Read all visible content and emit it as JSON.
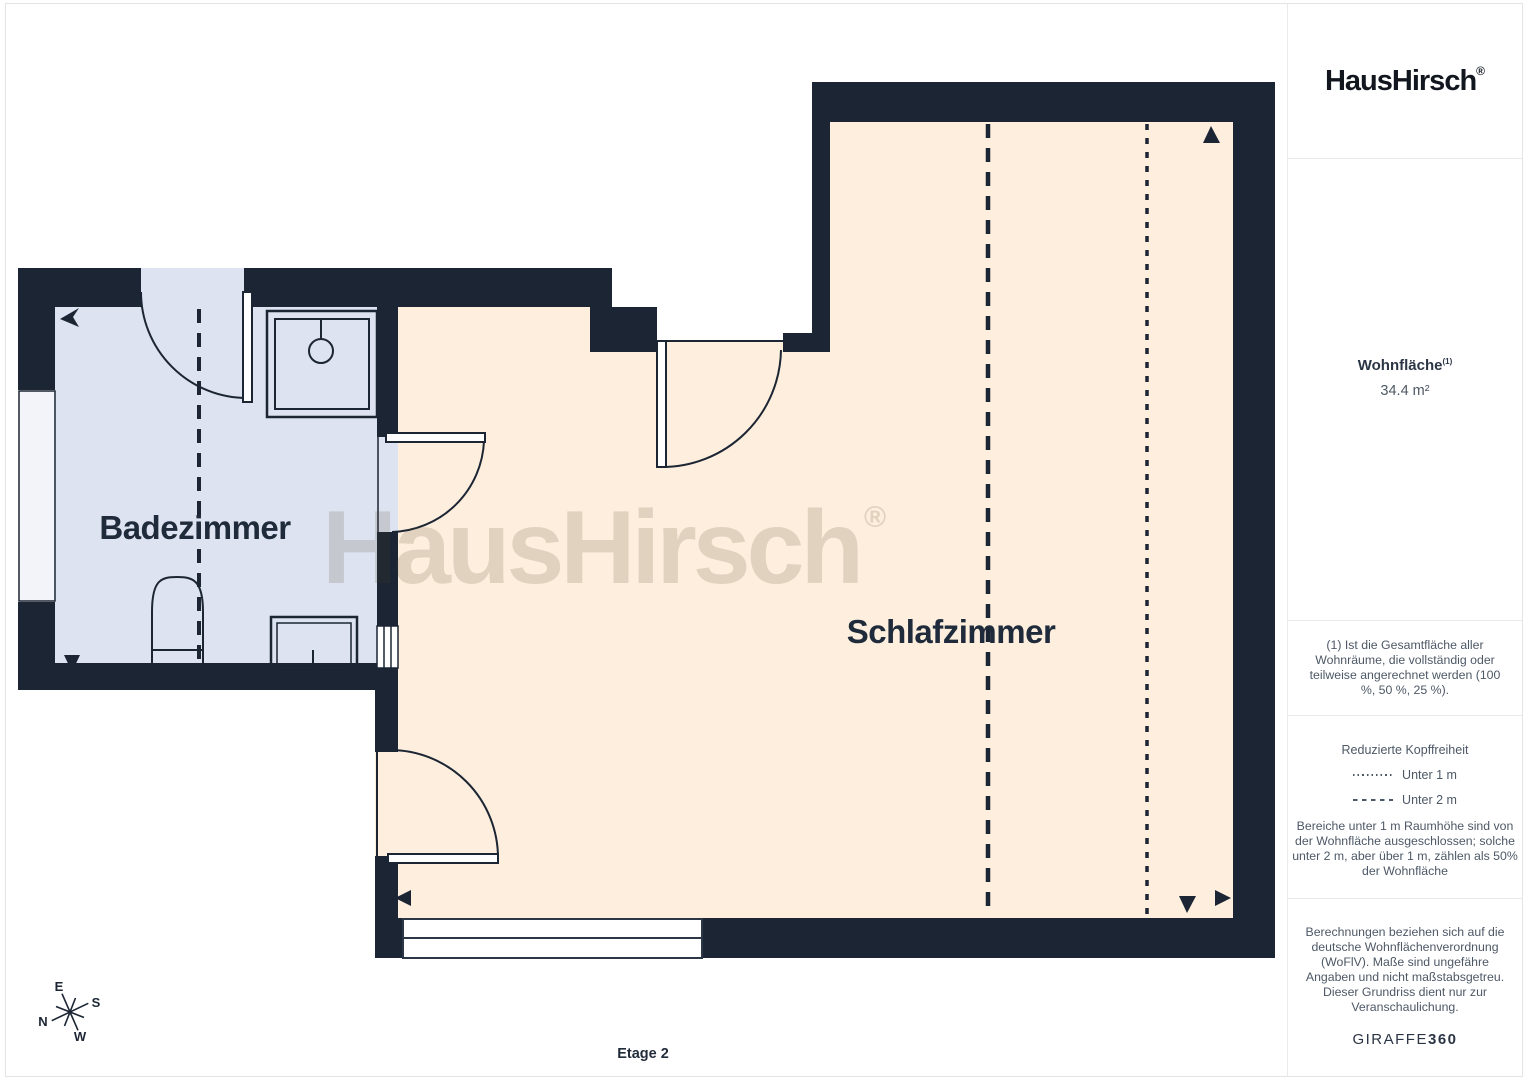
{
  "logo": {
    "brand": "HausHirsch",
    "registered": "®"
  },
  "floor_plan": {
    "rooms": [
      {
        "name": "Badezimmer"
      },
      {
        "name": "Schlafzimmer"
      }
    ],
    "watermark": {
      "text": "HausHirsch",
      "registered": "®"
    },
    "floor_label": "Etage 2",
    "compass": {
      "n": "N",
      "e": "E",
      "s": "S",
      "w": "W"
    },
    "colors": {
      "wall": "#1b2533",
      "bathroom_floor": "#dde3f0",
      "bedroom_floor": "#fdeedd",
      "window_fill": "#f3f4f9"
    }
  },
  "sidebar": {
    "area": {
      "label": "Wohnfläche",
      "footnote_ref": "(1)",
      "value": "34.4 m²"
    },
    "footnote": "(1) Ist die Gesamtfläche aller Wohnräume, die vollständig oder teilweise angerechnet werden (100 %, 50 %, 25 %).",
    "legend": {
      "title": "Reduzierte Kopffreiheit",
      "items": [
        {
          "label": "Unter 1 m",
          "style": "dotted"
        },
        {
          "label": "Unter 2 m",
          "style": "dashed"
        }
      ],
      "note": "Bereiche unter 1 m Raumhöhe sind von der Wohnfläche ausgeschlossen; solche unter 2 m, aber über 1 m, zählen als 50% der Wohnfläche"
    },
    "disclaimer": "Berechnungen beziehen sich auf die deutsche Wohnflächenverordnung (WoFlV). Maße sind ungefähre Angaben und nicht maßstabsgetreu. Dieser Grundriss dient nur zur Veranschaulichung.",
    "brand_footer": {
      "first": "GIRAFFE",
      "second": "360"
    }
  }
}
